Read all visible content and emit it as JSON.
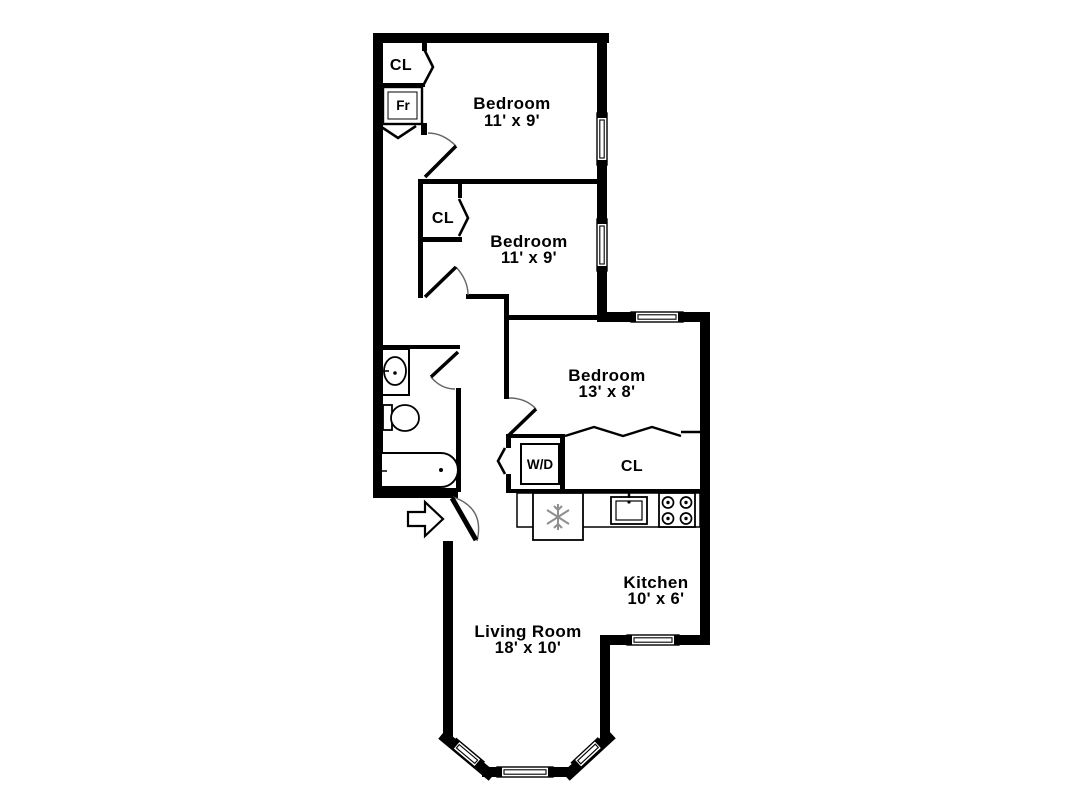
{
  "title": "Apartment floor plan",
  "colors": {
    "wall": "#000000",
    "background": "#ffffff",
    "door_arc": "#666666",
    "appliance_accent": "#8f8f8f"
  },
  "rooms": {
    "bedroom1": {
      "name": "Bedroom",
      "dims": "11' x 9'"
    },
    "bedroom2": {
      "name": "Bedroom",
      "dims": "11' x 9'"
    },
    "bedroom3": {
      "name": "Bedroom",
      "dims": "13' x 8'"
    },
    "kitchen": {
      "name": "Kitchen",
      "dims": "10' x 6'"
    },
    "living_room": {
      "name": "Living Room",
      "dims": "18' x 10'"
    }
  },
  "labels": {
    "bedroom1_closet": "CL",
    "bedroom2_closet": "CL",
    "kitchen_closet": "CL",
    "fr": "Fr",
    "washer_dryer": "W/D"
  },
  "fixtures": [
    "bathroom-sink",
    "toilet",
    "bathtub",
    "washer-dryer-box",
    "refrigerator-snowflake",
    "kitchen-sink",
    "stove-burners",
    "entry-arrow",
    "window",
    "door-swing",
    "bifold-door",
    "accordion-door"
  ]
}
